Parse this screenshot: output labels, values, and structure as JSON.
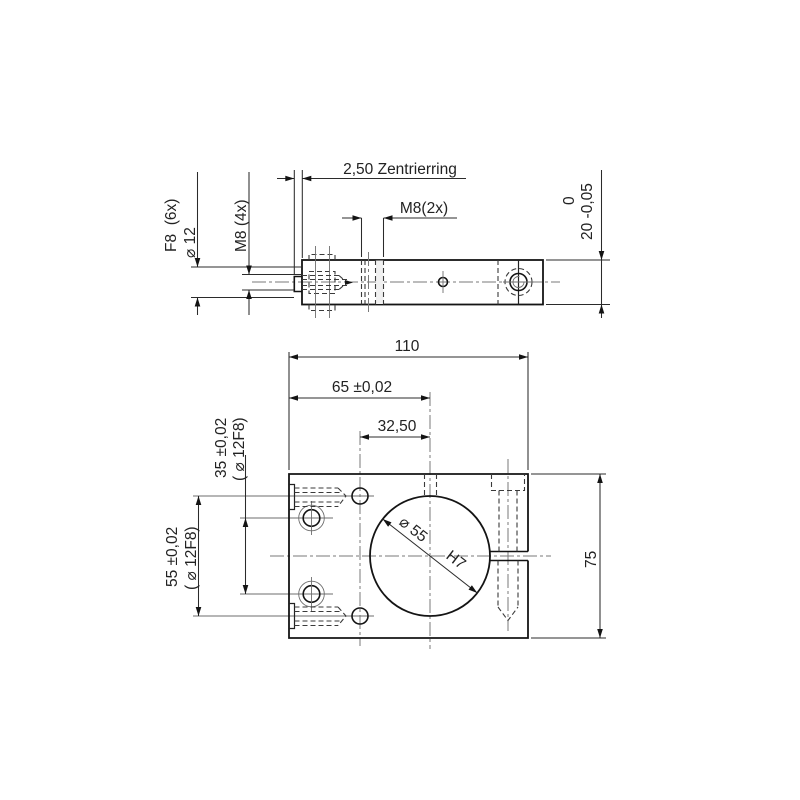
{
  "canvas": {
    "background": "#ffffff",
    "ink": "#1a1a1a"
  },
  "top_view": {
    "name": "side-view",
    "dims": {
      "zentrierring": "2,50 Zentrierring",
      "m8_2x": "M8(2x)",
      "d12_class": "F8  (6x)",
      "d12": "⌀ 12",
      "m8_4x": "M8 (4x)",
      "thickness_upper": "0",
      "thickness": "20 -0,05"
    }
  },
  "front_view": {
    "name": "front-view",
    "dims": {
      "width": "110",
      "center_65": "65 ±0,02",
      "center_325": "32,50",
      "spacing_55": "55 ±0,02",
      "spacing_55_holes": "( ⌀ 12F8)",
      "spacing_35": "35 ±0,02",
      "spacing_35_holes": "( ⌀ 12F8)",
      "height": "75",
      "bore": "⌀ 55",
      "bore_fit": "H7"
    }
  }
}
